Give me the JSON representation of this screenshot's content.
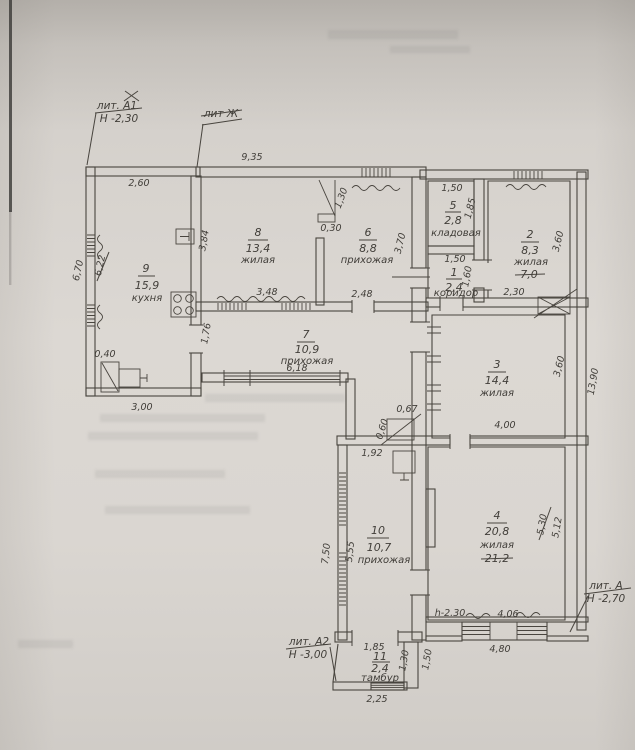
{
  "plan": {
    "colors": {
      "paper": "#dcd8d3",
      "ink": "#49453f"
    },
    "marks": {
      "lit_a1": "лит. А1",
      "lit_a1_h": "Н -2,30",
      "lit_zh": "лит Ж",
      "lit_a": "лит. А",
      "lit_a_h": "Н -2,70",
      "lit_a2": "лит. А2",
      "lit_a2_h": "Н -3,00",
      "h_note": "h-2.30"
    },
    "rooms": {
      "k9": {
        "num": "9",
        "area": "15,9",
        "name": "кухня"
      },
      "r8": {
        "num": "8",
        "area": "13,4",
        "name": "жилая"
      },
      "r6": {
        "num": "6",
        "area": "8,8",
        "name": "прихожая"
      },
      "r5": {
        "num": "5",
        "area": "2,8",
        "name": "кладовая"
      },
      "r1": {
        "num": "1",
        "area": "2,4",
        "name": "коридор"
      },
      "r2": {
        "num": "2",
        "area": "8,3",
        "name": "жилая",
        "old_area": "7,0"
      },
      "r7": {
        "num": "7",
        "area": "10,9",
        "name": "прихожая"
      },
      "r3": {
        "num": "3",
        "area": "14,4",
        "name": "жилая"
      },
      "r10": {
        "num": "10",
        "area": "10,7",
        "name": "прихожая"
      },
      "r4": {
        "num": "4",
        "area": "20,8",
        "name": "жилая",
        "old_area": "21,2"
      },
      "r11": {
        "num": "11",
        "area": "2,4",
        "name": "тамбур"
      }
    },
    "dims": {
      "top_width": "9,35",
      "kitchen_top": "2,60",
      "kitchen_left_outer": "6,70",
      "kitchen_left_inner": "6,22",
      "kitchen_niche": "0,40",
      "kitchen_bottom": "3,00",
      "r7_left": "1,76",
      "r7_length": "6,18",
      "r8_left": "3,84",
      "r8_bottom": "3,48",
      "door86": "1,30",
      "door86_jamb": "0,30",
      "r6_right": "3,70",
      "r6_bottom": "2,48",
      "r5_top": "1,50",
      "r5_right": "1,85",
      "r1_top": "1,50",
      "r1_right": "1,60",
      "r2_right": "3,60",
      "r2_bottom": "2,30",
      "r3_right": "3,60",
      "r3_bottom": "4,00",
      "right_total": "13,90",
      "flue_w": "0,67",
      "flue_h": "0,60",
      "r10_top": "1,92",
      "r10_left_outer": "7,50",
      "r10_left_inner": "5,55",
      "r4_right_old": "5,30",
      "r4_right": "5,12",
      "r4_bottom": "4,06",
      "r4_bottom_outer": "4,80",
      "r11_top": "1,85",
      "r11_right_inner": "1,30",
      "r11_right_outer": "1,50",
      "r11_bottom": "2,25"
    }
  }
}
